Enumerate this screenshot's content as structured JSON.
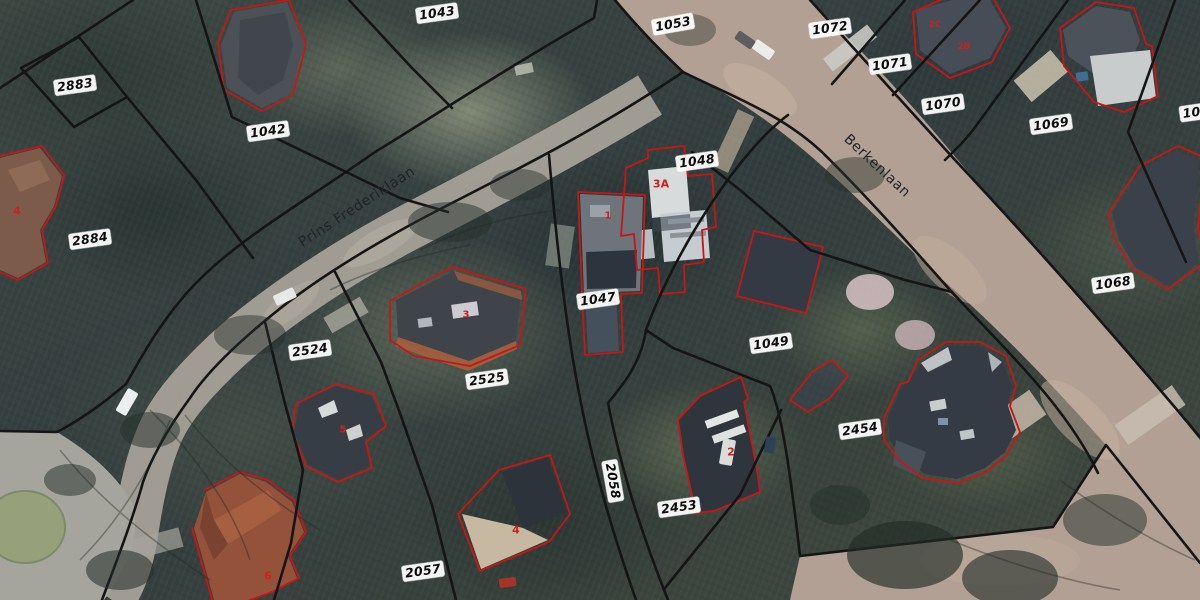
{
  "map": {
    "view": "aerial-cadastral-photo",
    "street_names": [
      "Prins Frederiklaan",
      "Berkenlaan"
    ],
    "parcel_numbers": [
      "2883",
      "1042",
      "1043",
      "1053",
      "1072",
      "1071",
      "1070",
      "1069",
      "106",
      "2884",
      "1048",
      "1047",
      "1068",
      "2524",
      "2525",
      "1049",
      "2454",
      "2453",
      "2058",
      "2057"
    ],
    "house_numbers": [
      "4",
      "3",
      "1",
      "3A",
      "2C",
      "2B",
      "2",
      "5",
      "4",
      "6"
    ],
    "colors": {
      "parcel_boundary": "#151515",
      "building_outline": "#c81616",
      "parcel_label_bg": "#ffffff",
      "parcel_label_text": "#0b0b0b",
      "house_number_text": "#cf1f1f",
      "street_name_text": "#20242a",
      "road_berkenlaan": "#b2a094",
      "road_frederiklaan": "#a5a199"
    }
  }
}
